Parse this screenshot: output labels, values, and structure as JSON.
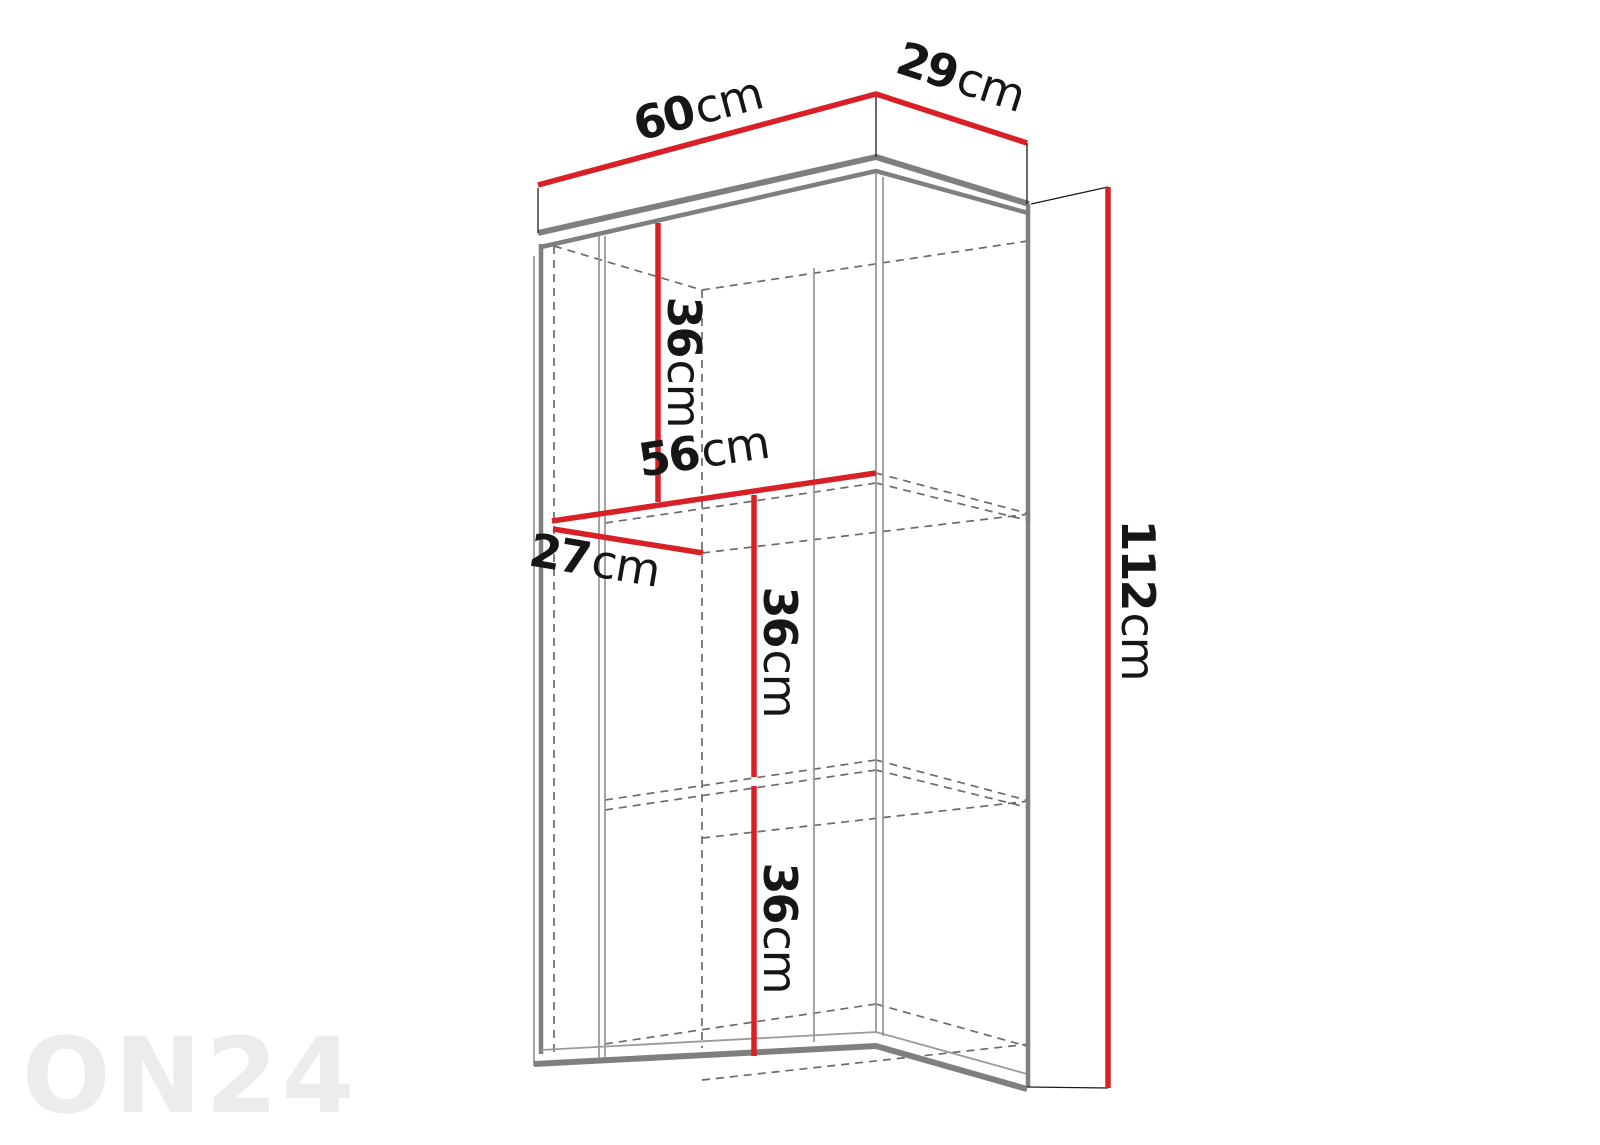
{
  "diagram_title": "wall-cabinet-dimension-drawing",
  "watermark": "ON24",
  "colors": {
    "dimension_red": "#d92027",
    "outline_gray": "#7f7f7f",
    "thin_gray": "#9a9a9a",
    "dashed_gray": "#6b6b6b",
    "label_black": "#161616",
    "watermark_gray": "#ececec",
    "background": "#ffffff"
  },
  "dimensions": {
    "outer_width": {
      "value": "60",
      "unit": "cm"
    },
    "outer_depth": {
      "value": "29",
      "unit": "cm"
    },
    "outer_height": {
      "value": "112",
      "unit": "cm"
    },
    "inner_width": {
      "value": "56",
      "unit": "cm"
    },
    "inner_depth": {
      "value": "27",
      "unit": "cm"
    },
    "compartment_top": {
      "value": "36",
      "unit": "cm"
    },
    "compartment_middle": {
      "value": "36",
      "unit": "cm"
    },
    "compartment_bottom": {
      "value": "36",
      "unit": "cm"
    }
  }
}
